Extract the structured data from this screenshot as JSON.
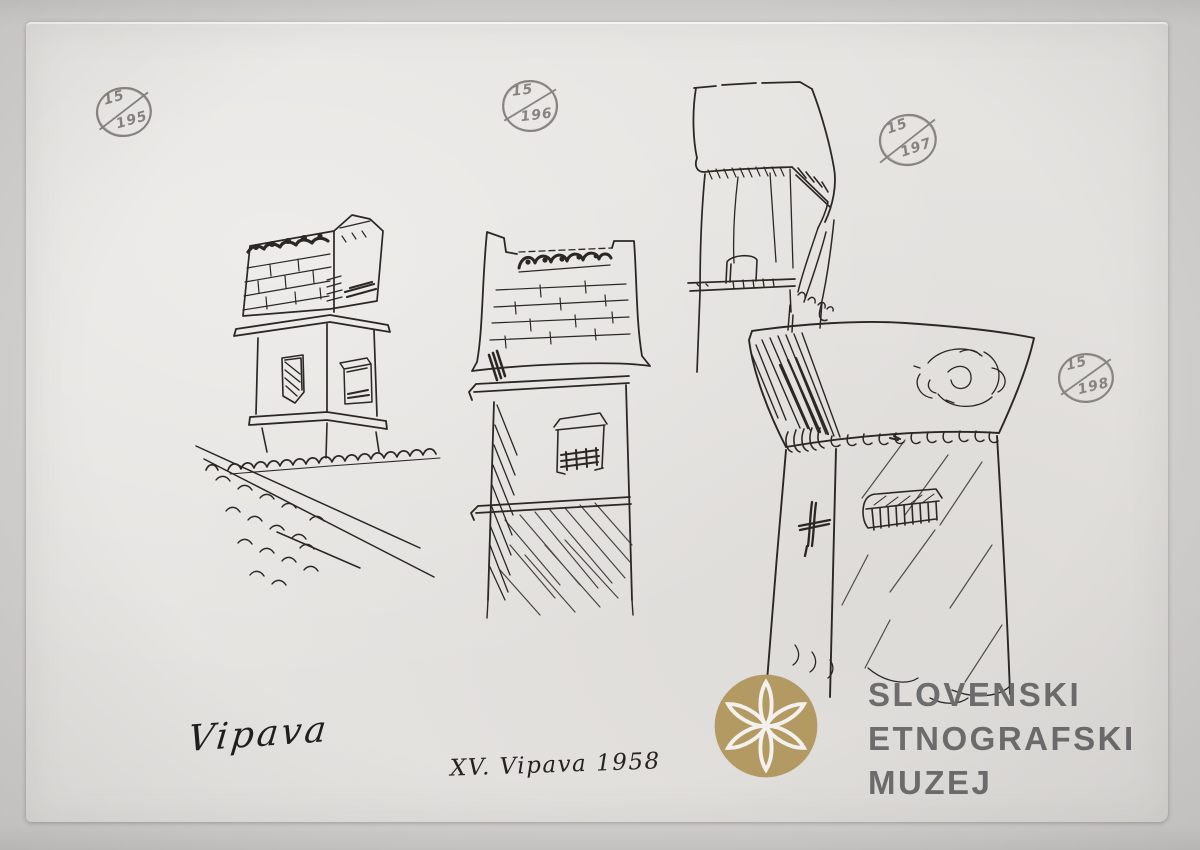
{
  "stamps": [
    {
      "top": "15",
      "bottom": "195"
    },
    {
      "top": "15",
      "bottom": "196"
    },
    {
      "top": "15",
      "bottom": "197"
    },
    {
      "top": "15",
      "bottom": "198"
    }
  ],
  "inscriptions": {
    "signature": "Vipava",
    "caption": "XV. Vipava 1958"
  },
  "logo": {
    "lines": [
      "SLOVENSKI",
      "ETNOGRAFSKI",
      "MUZEJ"
    ],
    "rosette_icon": "six-petal-rosette",
    "circle_color": "#b39a62",
    "text_color": "#6d6d6d"
  },
  "figures": [
    {
      "id": "chimney-sketch-195",
      "stamp": "15/195"
    },
    {
      "id": "chimney-sketch-196",
      "stamp": "15/196"
    },
    {
      "id": "chimney-sketch-197",
      "stamp": "15/197"
    },
    {
      "id": "chimney-sketch-198",
      "stamp": "15/198"
    }
  ],
  "colors": {
    "scan_background": "#d2d0ce",
    "paper": "#e6e4e1",
    "ink": "#2b2824",
    "pencil": "#87847f"
  }
}
